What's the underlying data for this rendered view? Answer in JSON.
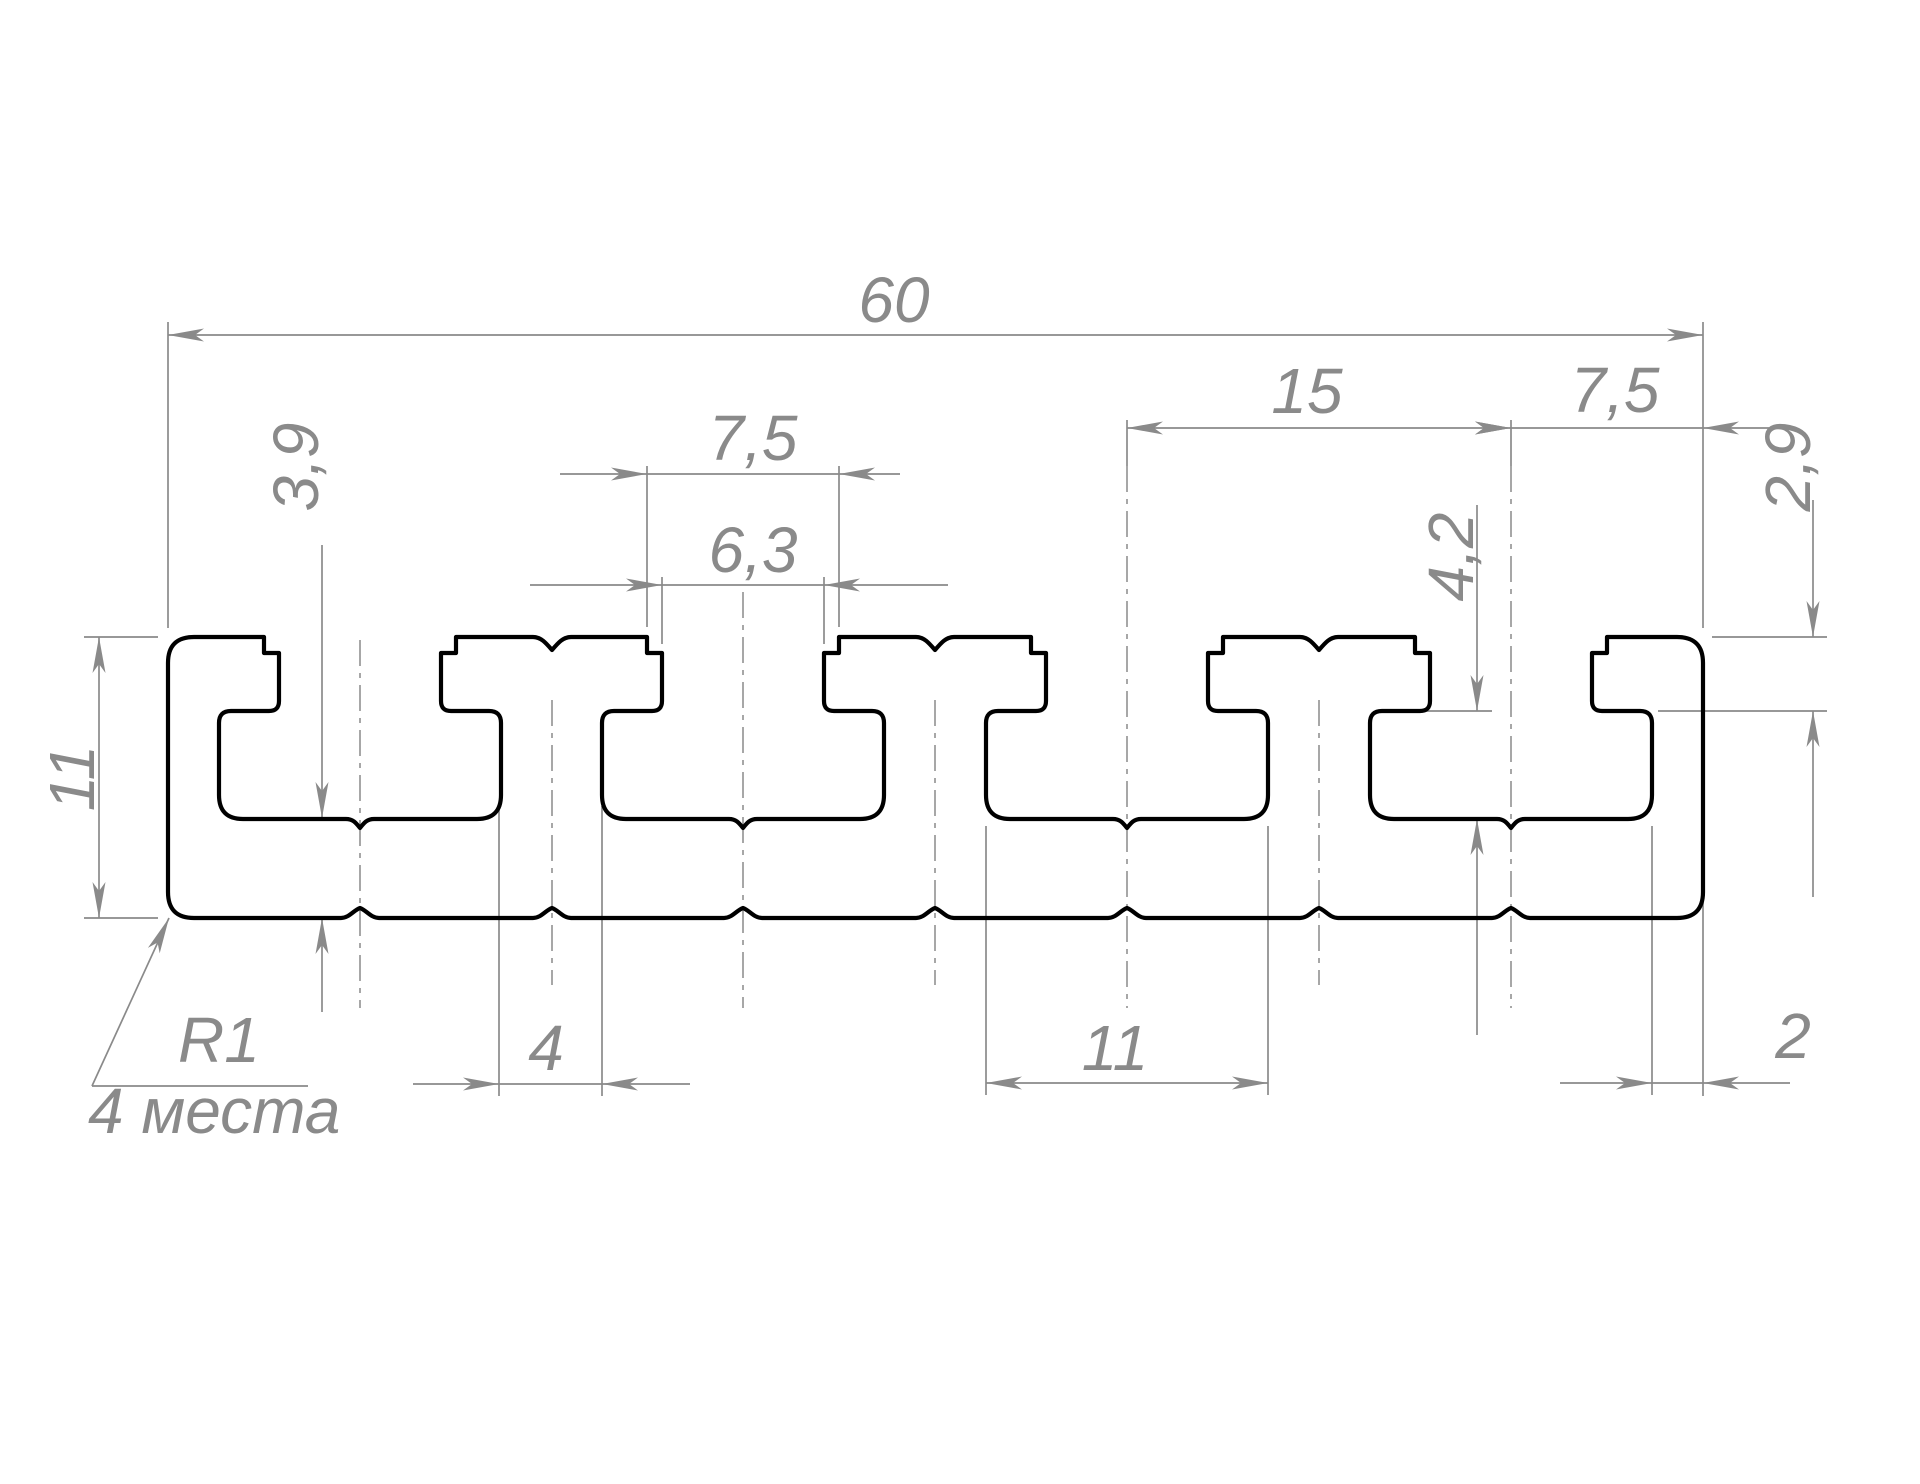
{
  "drawing": {
    "type": "technical-drawing",
    "subject": "aluminum T-slot plate profile cross-section",
    "units": "mm",
    "language": "ru",
    "colors": {
      "outline": "#000000",
      "dimension": "#8a8a8a",
      "background": "#ffffff"
    },
    "profile_mm": {
      "total_width": 60,
      "total_height": 11,
      "slot_count": 4,
      "slot_pitch": 15,
      "edge_to_slot_center": 7.5,
      "slot_top_opening": 7.5,
      "slot_lip_opening": 6.3,
      "neck_depth": 2.9,
      "cavity_depth": 4.2,
      "cavity_width": 11,
      "web_between_cavities": 4,
      "edge_wall": 2,
      "floor_below_cavity": 3.9,
      "outer_corner_radius": 1,
      "corner_radius_places": 4
    },
    "profile_px": {
      "x0": 168,
      "x1": 1703,
      "yTop": 637,
      "yBot": 918,
      "slotCenters": [
        360,
        743,
        1127,
        1511
      ],
      "toothCenters": [
        552,
        935,
        1319
      ],
      "halfOpen": 96,
      "halfTip": 81,
      "halfCav": 141,
      "yStep": 653,
      "yNeckBot": 701,
      "yUnder": 711,
      "yWallBot": 795,
      "yFloor": 819,
      "cornerR": 26,
      "toothNotch": {
        "halfW": 19,
        "depth": 13
      },
      "floorNotch": {
        "halfW": 14,
        "depth": 9
      },
      "bottomNotch": {
        "halfW": 19,
        "depth": 10
      },
      "strokeOutline": 4.2,
      "strokeDim": 1.7,
      "strokeCenter": 1.5,
      "fontSize": 64
    },
    "centerlines": [
      {
        "name": "slot-1-center",
        "x": 360,
        "y1": 640,
        "y2": 1008
      },
      {
        "name": "slot-2-center",
        "x": 743,
        "y1": 592,
        "y2": 1008
      },
      {
        "name": "slot-3-center",
        "x": 1127,
        "y1": 466,
        "y2": 1008
      },
      {
        "name": "slot-4-center",
        "x": 1511,
        "y1": 466,
        "y2": 1008
      },
      {
        "name": "tooth-1-center",
        "x": 552,
        "y1": 700,
        "y2": 985
      },
      {
        "name": "tooth-2-center",
        "x": 935,
        "y1": 700,
        "y2": 985
      },
      {
        "name": "tooth-3-center",
        "x": 1319,
        "y1": 700,
        "y2": 985
      }
    ],
    "dimensions": [
      {
        "id": "total-width",
        "label": "60",
        "value_mm": 60,
        "lines": [
          [
            168,
            335,
            1703,
            335
          ]
        ],
        "ext": [
          [
            168,
            322,
            168,
            628
          ],
          [
            1703,
            322,
            1703,
            628
          ],
          [
            1703,
            902,
            1703,
            1096
          ]
        ],
        "arrows": [
          [
            168,
            335,
            180
          ],
          [
            1703,
            335,
            0
          ]
        ],
        "text": {
          "x": 894,
          "y": 322,
          "rot": 0,
          "anchor": "middle"
        }
      },
      {
        "id": "slot-pitch",
        "label": "15",
        "value_mm": 15,
        "lines": [
          [
            1127,
            428,
            1511,
            428
          ]
        ],
        "ext": [
          [
            1127,
            420,
            1127,
            466
          ],
          [
            1511,
            420,
            1511,
            466
          ]
        ],
        "arrows": [
          [
            1127,
            428,
            180
          ],
          [
            1511,
            428,
            0
          ]
        ],
        "text": {
          "x": 1307,
          "y": 413,
          "rot": 0,
          "anchor": "middle"
        }
      },
      {
        "id": "edge-to-slot",
        "label": "7,5",
        "value_mm": 7.5,
        "lines": [
          [
            1511,
            428,
            1788,
            428
          ]
        ],
        "ext": [],
        "arrows": [
          [
            1511,
            428,
            0
          ],
          [
            1703,
            428,
            180
          ]
        ],
        "text": {
          "x": 1615,
          "y": 412,
          "rot": 0,
          "anchor": "middle"
        }
      },
      {
        "id": "slot-top-opening",
        "label": "7,5",
        "value_mm": 7.5,
        "lines": [
          [
            560,
            474,
            900,
            474
          ]
        ],
        "ext": [
          [
            647,
            466,
            647,
            627
          ],
          [
            839,
            466,
            839,
            627
          ]
        ],
        "arrows": [
          [
            647,
            474,
            0
          ],
          [
            839,
            474,
            180
          ]
        ],
        "text": {
          "x": 753,
          "y": 460,
          "rot": 0,
          "anchor": "middle"
        }
      },
      {
        "id": "slot-lip-opening",
        "label": "6,3",
        "value_mm": 6.3,
        "lines": [
          [
            530,
            585,
            948,
            585
          ]
        ],
        "ext": [
          [
            662,
            577,
            662,
            644
          ],
          [
            824,
            577,
            824,
            644
          ]
        ],
        "arrows": [
          [
            662,
            585,
            0
          ],
          [
            824,
            585,
            180
          ]
        ],
        "text": {
          "x": 753,
          "y": 572,
          "rot": 0,
          "anchor": "middle"
        }
      },
      {
        "id": "floor-thickness",
        "label": "3,9",
        "value_mm": 3.9,
        "lines": [
          [
            322,
            545,
            322,
            818
          ],
          [
            322,
            918,
            322,
            1012
          ]
        ],
        "ext": [],
        "arrows": [
          [
            322,
            818,
            90
          ],
          [
            322,
            918,
            -90
          ]
        ],
        "text": {
          "x": 318,
          "y": 467,
          "rot": -90,
          "anchor": "middle"
        }
      },
      {
        "id": "neck-depth",
        "label": "2,9",
        "value_mm": 2.9,
        "lines": [
          [
            1813,
            500,
            1813,
            637
          ],
          [
            1813,
            711,
            1813,
            897
          ]
        ],
        "ext": [
          [
            1712,
            637,
            1827,
            637
          ],
          [
            1658,
            711,
            1827,
            711
          ]
        ],
        "arrows": [
          [
            1813,
            637,
            90
          ],
          [
            1813,
            711,
            -90
          ]
        ],
        "text": {
          "x": 1810,
          "y": 467,
          "rot": -90,
          "anchor": "middle"
        }
      },
      {
        "id": "cavity-depth",
        "label": "4,2",
        "value_mm": 4.2,
        "lines": [
          [
            1477,
            505,
            1477,
            711
          ],
          [
            1477,
            819,
            1477,
            1035
          ]
        ],
        "ext": [
          [
            1425,
            711,
            1492,
            711
          ]
        ],
        "arrows": [
          [
            1477,
            711,
            90
          ],
          [
            1477,
            819,
            -90
          ]
        ],
        "text": {
          "x": 1473,
          "y": 557,
          "rot": -90,
          "anchor": "middle"
        }
      },
      {
        "id": "total-height",
        "label": "11",
        "value_mm": 11,
        "lines": [
          [
            99,
            637,
            99,
            918
          ]
        ],
        "ext": [
          [
            84,
            637,
            158,
            637
          ],
          [
            84,
            918,
            158,
            918
          ]
        ],
        "arrows": [
          [
            99,
            637,
            -90
          ],
          [
            99,
            918,
            90
          ]
        ],
        "text": {
          "x": 94,
          "y": 778,
          "rot": -90,
          "anchor": "middle"
        }
      },
      {
        "id": "web-width",
        "label": "4",
        "value_mm": 4,
        "lines": [
          [
            413,
            1084,
            690,
            1084
          ]
        ],
        "ext": [
          [
            499,
            806,
            499,
            1096
          ],
          [
            602,
            806,
            602,
            1096
          ]
        ],
        "arrows": [
          [
            499,
            1084,
            0
          ],
          [
            602,
            1084,
            180
          ]
        ],
        "text": {
          "x": 546,
          "y": 1070,
          "rot": 0,
          "anchor": "middle"
        }
      },
      {
        "id": "cavity-width",
        "label": "11",
        "value_mm": 11,
        "lines": [
          [
            986,
            1083,
            1268,
            1083
          ]
        ],
        "ext": [
          [
            986,
            826,
            986,
            1095
          ],
          [
            1268,
            826,
            1268,
            1095
          ]
        ],
        "arrows": [
          [
            986,
            1083,
            180
          ],
          [
            1268,
            1083,
            0
          ]
        ],
        "text": {
          "x": 1115,
          "y": 1070,
          "rot": 0,
          "anchor": "middle"
        }
      },
      {
        "id": "edge-wall",
        "label": "2",
        "value_mm": 2,
        "lines": [
          [
            1560,
            1083,
            1790,
            1083
          ]
        ],
        "ext": [
          [
            1652,
            826,
            1652,
            1095
          ]
        ],
        "arrows": [
          [
            1652,
            1083,
            0
          ],
          [
            1703,
            1083,
            180
          ]
        ],
        "text": {
          "x": 1793,
          "y": 1058,
          "rot": 0,
          "anchor": "middle"
        }
      }
    ],
    "radius_note": {
      "line1": "R1",
      "line2": "4 места",
      "leader": [
        [
          92,
          1086,
          169,
          918
        ],
        [
          92,
          1086,
          308,
          1086
        ]
      ],
      "arrow": [
        169,
        918,
        -65
      ],
      "text1": {
        "x": 178,
        "y": 1062
      },
      "text2": {
        "x": 88,
        "y": 1133
      }
    }
  }
}
